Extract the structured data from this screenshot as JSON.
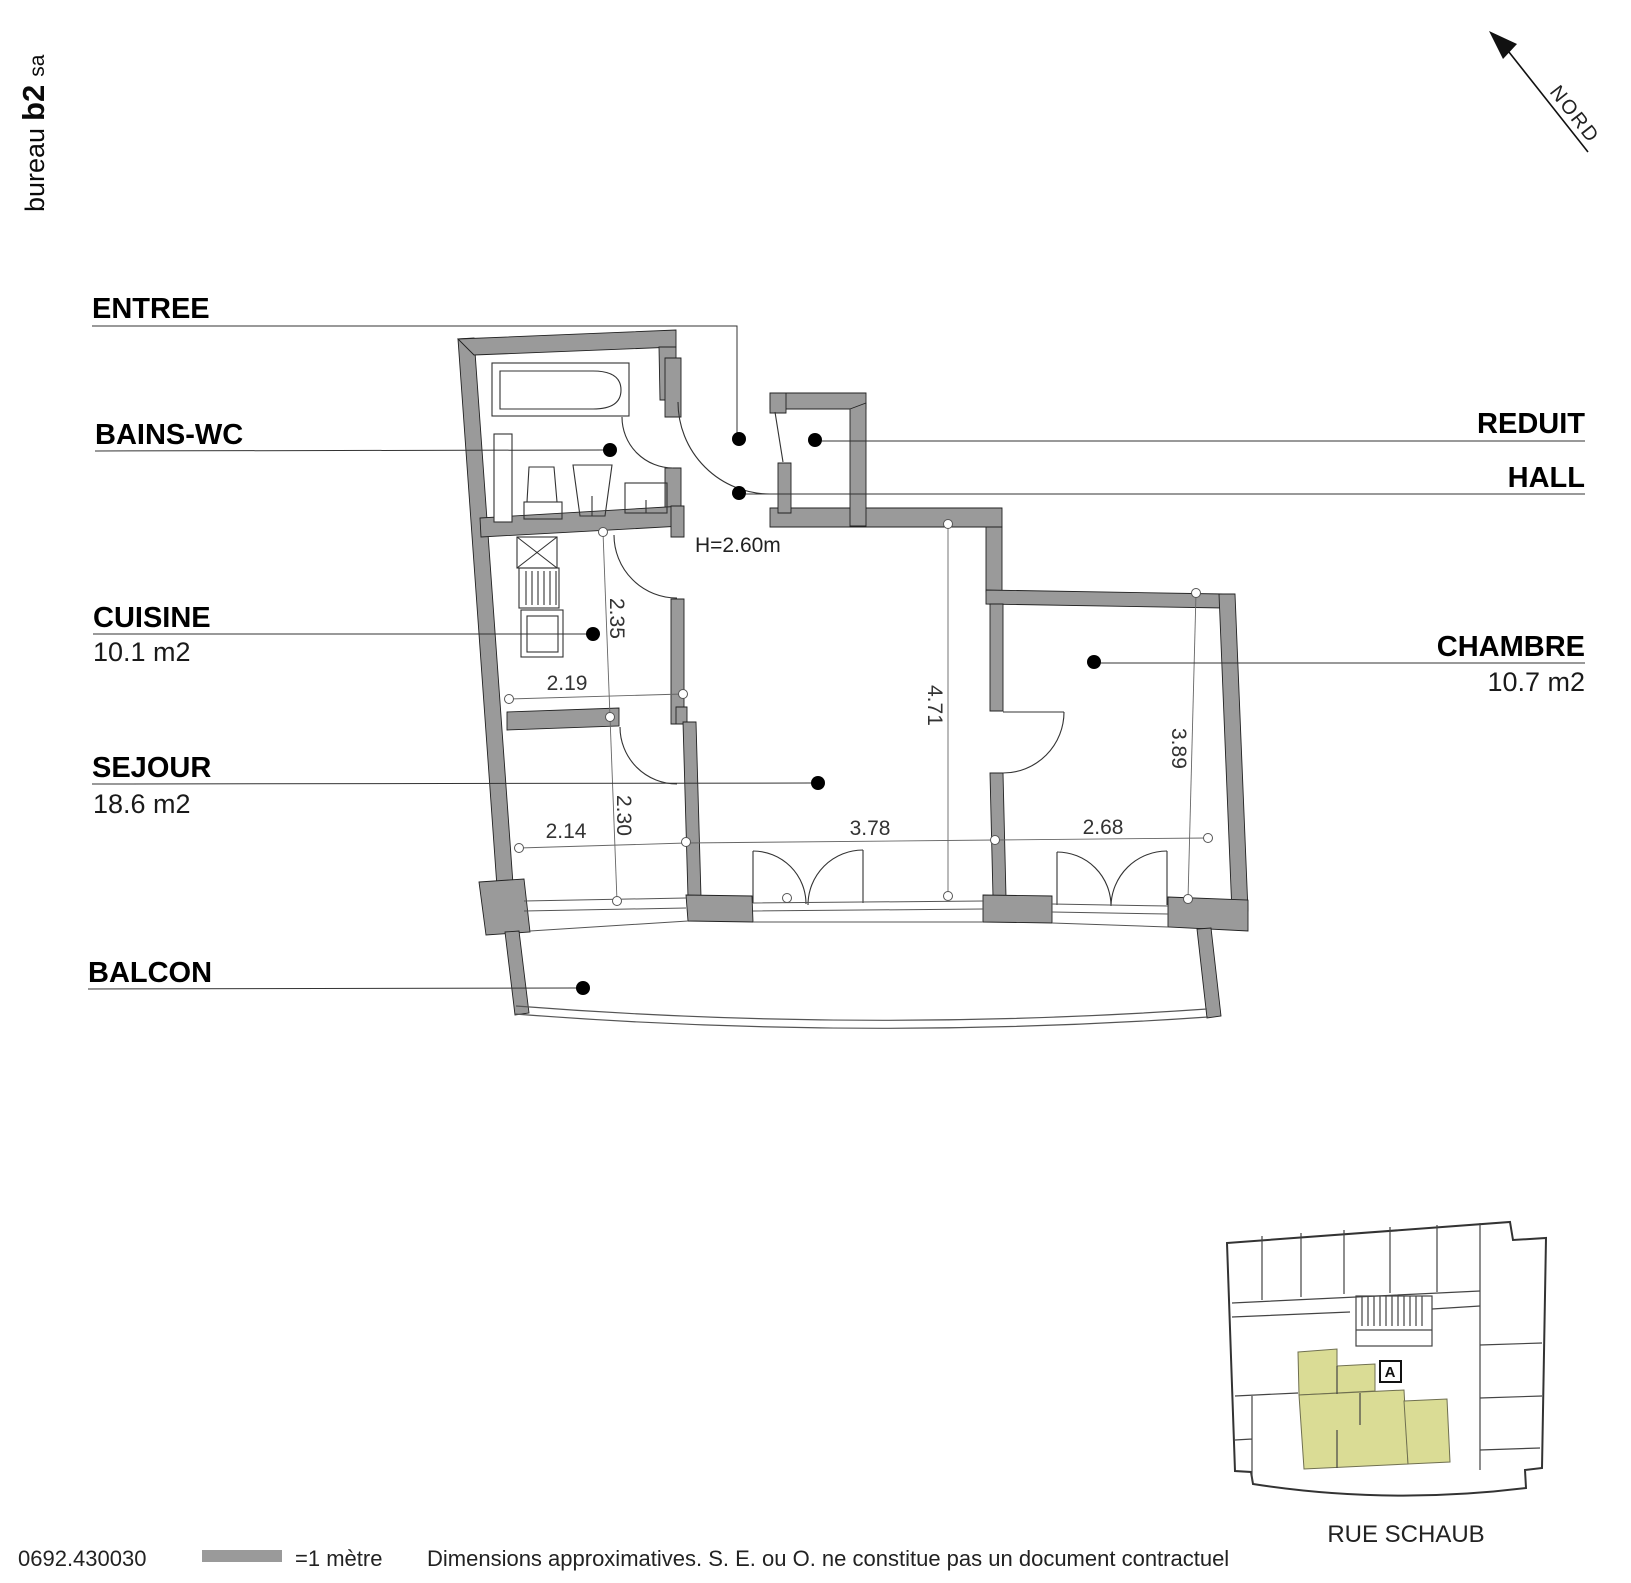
{
  "logo": {
    "prefix": "bureau",
    "brand": "b2",
    "suffix": "sa"
  },
  "compass": {
    "label": "NORD"
  },
  "plan": {
    "labels": {
      "entree": "ENTREE",
      "bains_wc": "BAINS-WC",
      "cuisine": "CUISINE",
      "cuisine_area": "10.1 m2",
      "sejour": "SEJOUR",
      "sejour_area": "18.6 m2",
      "balcon": "BALCON",
      "reduit": "REDUIT",
      "hall": "HALL",
      "chambre": "CHAMBRE",
      "chambre_area": "10.7 m2",
      "ceiling_height": "H=2.60m"
    },
    "dims": {
      "cuisine_upper_depth": "2.35",
      "cuisine_width": "2.19",
      "cuisine_lower_depth": "2.30",
      "bay_window_width": "2.14",
      "sejour_width": "3.78",
      "chambre_window_width": "2.68",
      "sejour_depth": "4.71",
      "chambre_depth": "3.89"
    }
  },
  "key_plan": {
    "street": "RUE SCHAUB",
    "unit_label": "A"
  },
  "footer": {
    "reference": "0692.430030",
    "scale_label": "=1 mètre",
    "disclaimer": "Dimensions approximatives. S. E. ou O. ne constitue pas un document contractuel"
  },
  "colors": {
    "wall_gray": "#9a9a9a",
    "highlight": "#dadc95"
  }
}
